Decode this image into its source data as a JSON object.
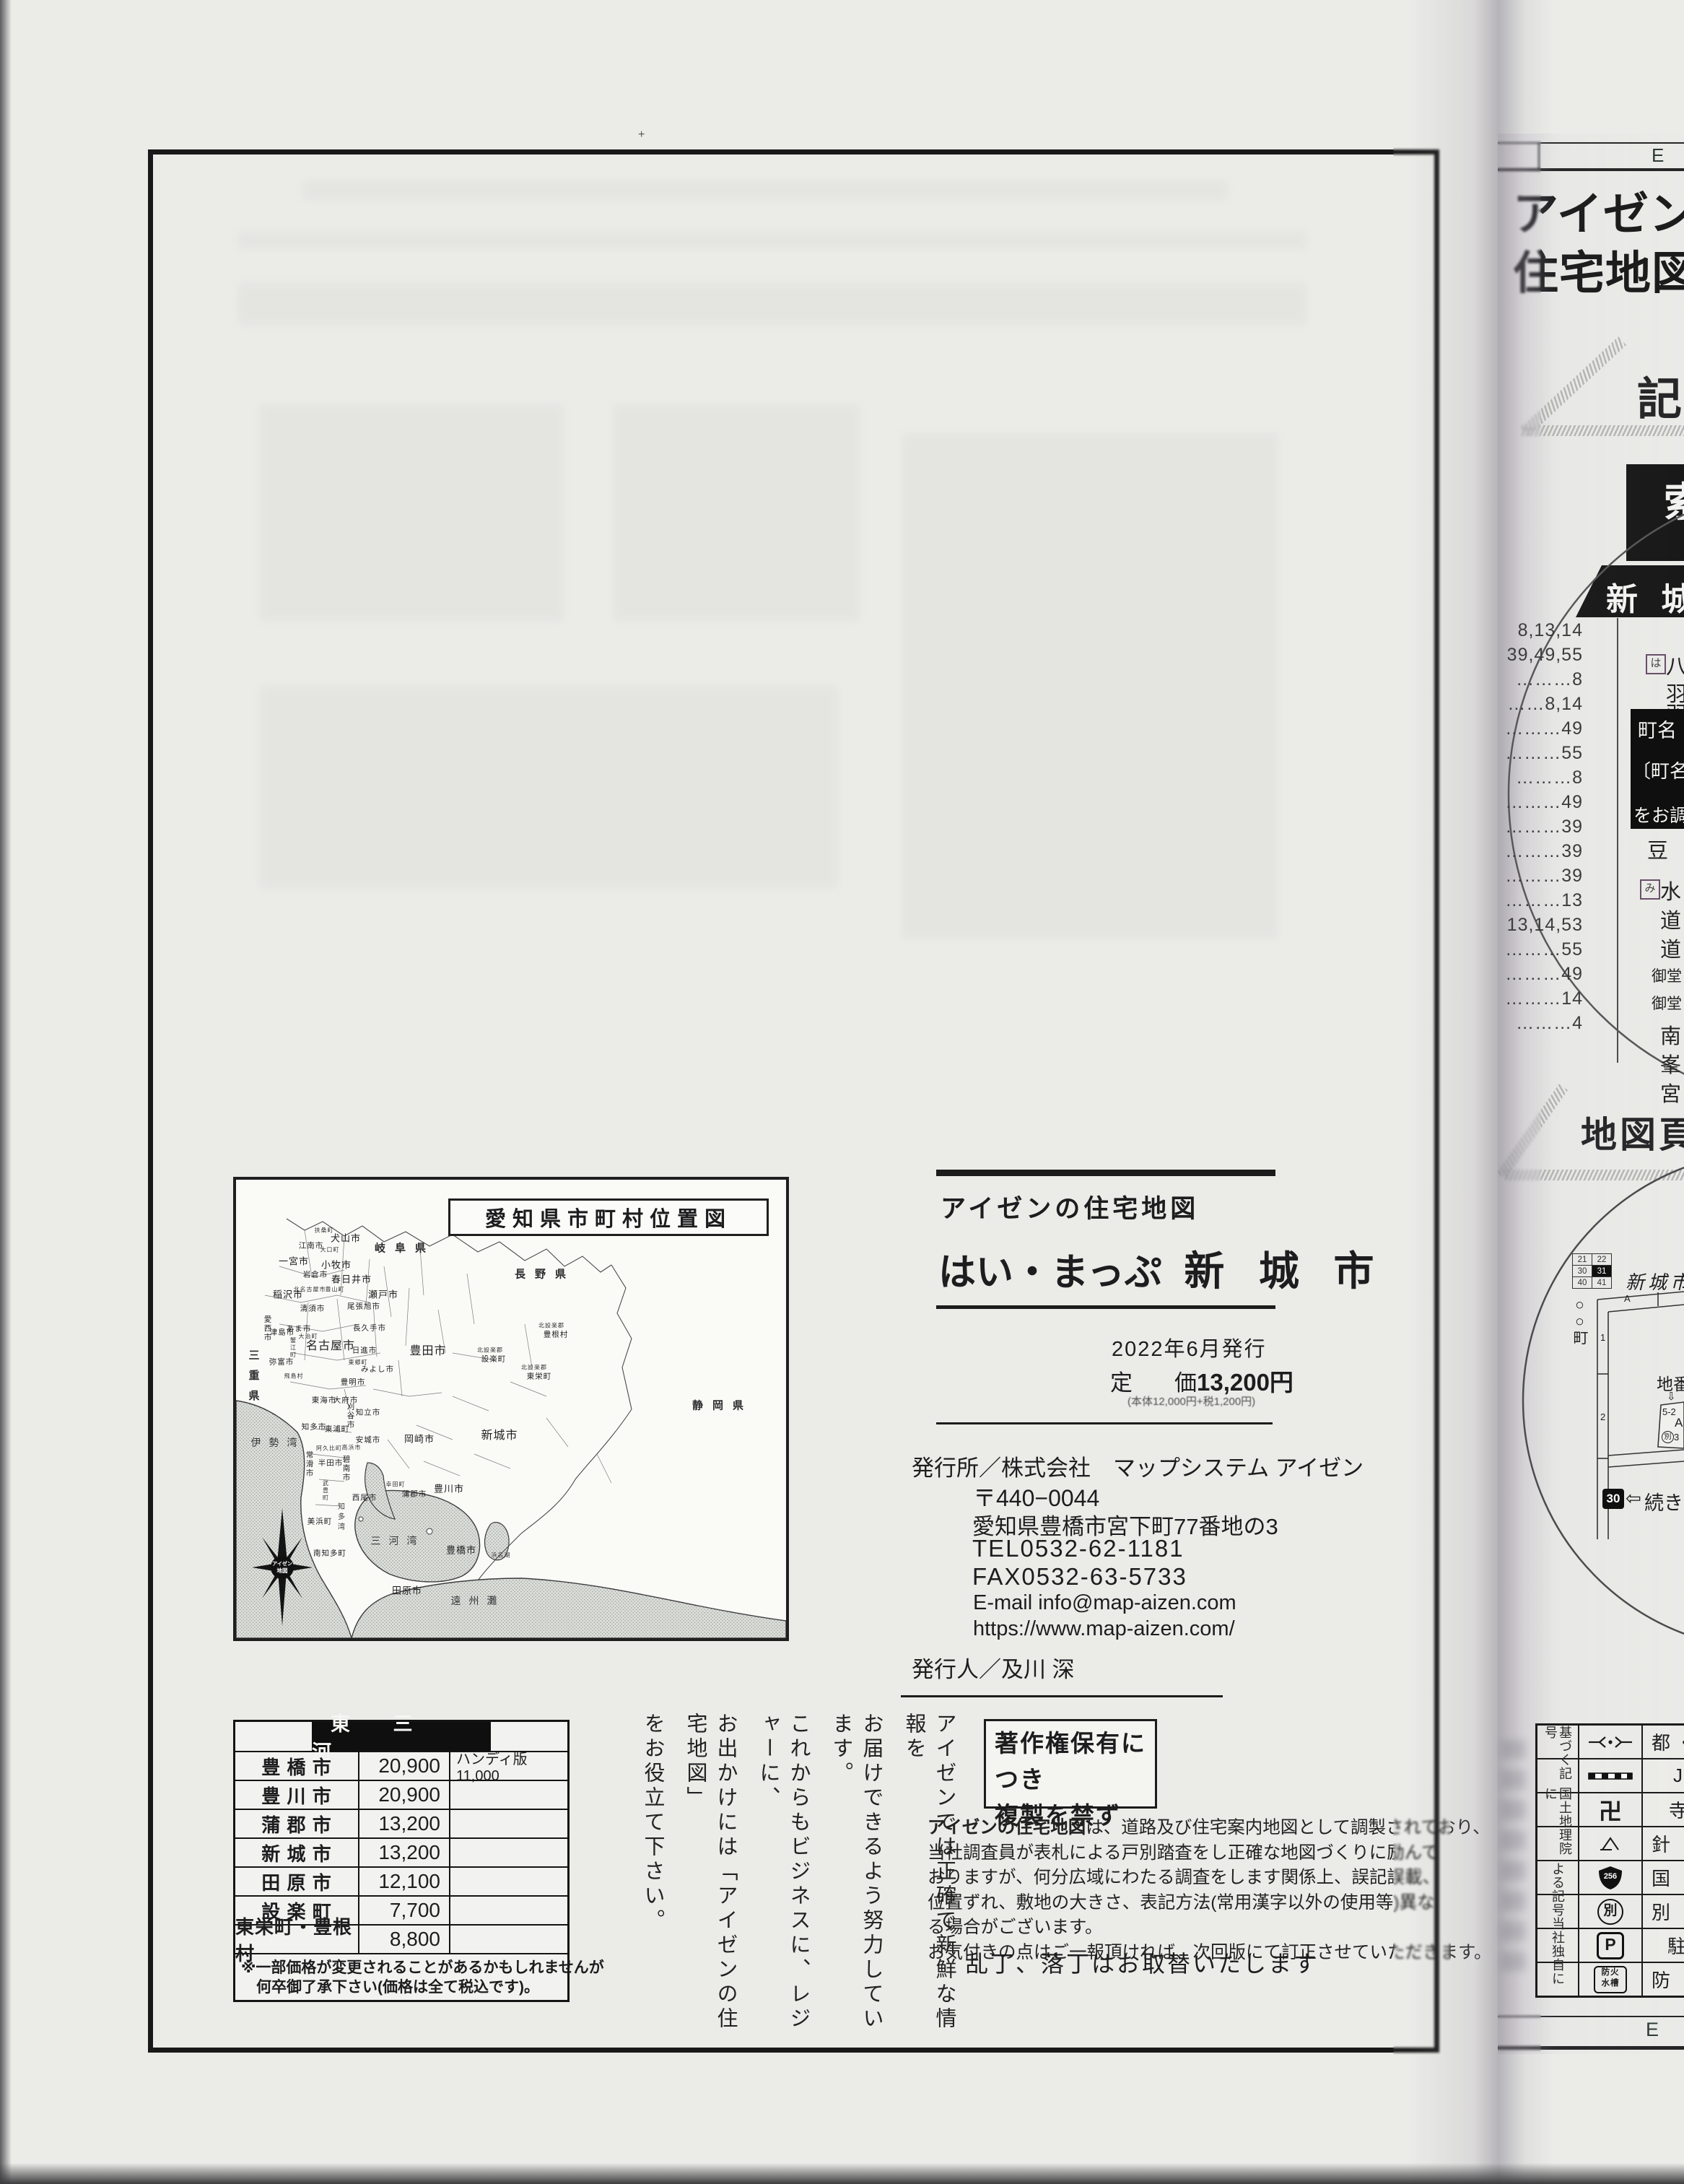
{
  "left": {
    "map": {
      "title": "愛知県市町村位置図",
      "compass_logo_line1": "アイゼン",
      "compass_logo_line2": "地図",
      "labels": [
        {
          "t": "岐阜県",
          "x": 234,
          "y": 94,
          "cls": "pref"
        },
        {
          "t": "長野県",
          "x": 428,
          "y": 130,
          "cls": "pref"
        },
        {
          "t": "静岡県",
          "x": 674,
          "y": 312,
          "cls": "pref"
        },
        {
          "t": "三重県",
          "x": 24,
          "y": 277,
          "cls": "pref v"
        },
        {
          "t": "伊勢湾",
          "x": 58,
          "y": 364,
          "cls": "sea"
        },
        {
          "t": "三河湾",
          "x": 224,
          "y": 500,
          "cls": "sea"
        },
        {
          "t": "遠州灘",
          "x": 335,
          "y": 583,
          "cls": "sea"
        },
        {
          "t": "知多湾",
          "x": 144,
          "y": 468,
          "cls": "sea v vsm"
        },
        {
          "t": "浜名湖",
          "x": 367,
          "y": 520,
          "cls": "xs"
        },
        {
          "t": "扶桑町",
          "x": 122,
          "y": 70,
          "cls": "xs"
        },
        {
          "t": "犬山市",
          "x": 152,
          "y": 80,
          "cls": ""
        },
        {
          "t": "江南市",
          "x": 104,
          "y": 91,
          "cls": "sm"
        },
        {
          "t": "大口町",
          "x": 130,
          "y": 97,
          "cls": "xs"
        },
        {
          "t": "一宮市",
          "x": 80,
          "y": 112,
          "cls": ""
        },
        {
          "t": "小牧市",
          "x": 139,
          "y": 117,
          "cls": ""
        },
        {
          "t": "岩倉市",
          "x": 110,
          "y": 131,
          "cls": "sm"
        },
        {
          "t": "春日井市",
          "x": 160,
          "y": 137,
          "cls": ""
        },
        {
          "t": "北名古屋市",
          "x": 102,
          "y": 152,
          "cls": "xs"
        },
        {
          "t": "豊山町",
          "x": 137,
          "y": 152,
          "cls": "xs"
        },
        {
          "t": "稲沢市",
          "x": 72,
          "y": 158,
          "cls": ""
        },
        {
          "t": "瀬戸市",
          "x": 204,
          "y": 158,
          "cls": ""
        },
        {
          "t": "清須市",
          "x": 106,
          "y": 178,
          "cls": "sm"
        },
        {
          "t": "尾張旭市",
          "x": 177,
          "y": 175,
          "cls": "sm"
        },
        {
          "t": "長久手市",
          "x": 185,
          "y": 205,
          "cls": "sm"
        },
        {
          "t": "愛西市",
          "x": 44,
          "y": 206,
          "cls": "v sm"
        },
        {
          "t": "あま市",
          "x": 87,
          "y": 206,
          "cls": "sm"
        },
        {
          "t": "大治町",
          "x": 100,
          "y": 217,
          "cls": "xs"
        },
        {
          "t": "津島市",
          "x": 64,
          "y": 211,
          "cls": "sm"
        },
        {
          "t": "名古屋市",
          "x": 131,
          "y": 228,
          "cls": "lg"
        },
        {
          "t": "日進市",
          "x": 178,
          "y": 236,
          "cls": "sm"
        },
        {
          "t": "豊田市",
          "x": 266,
          "y": 235,
          "cls": "lg"
        },
        {
          "t": "蟹江町",
          "x": 79,
          "y": 233,
          "cls": "xs v"
        },
        {
          "t": "弥富市",
          "x": 63,
          "y": 252,
          "cls": "sm"
        },
        {
          "t": "東郷町",
          "x": 169,
          "y": 253,
          "cls": "xs"
        },
        {
          "t": "みよし市",
          "x": 196,
          "y": 262,
          "cls": "sm"
        },
        {
          "t": "飛島村",
          "x": 80,
          "y": 272,
          "cls": "xs"
        },
        {
          "t": "豊明市",
          "x": 162,
          "y": 280,
          "cls": "sm"
        },
        {
          "t": "東海市",
          "x": 122,
          "y": 305,
          "cls": "sm"
        },
        {
          "t": "大府市",
          "x": 152,
          "y": 305,
          "cls": "sm"
        },
        {
          "t": "刈谷市",
          "x": 159,
          "y": 327,
          "cls": "v sm"
        },
        {
          "t": "知立市",
          "x": 183,
          "y": 322,
          "cls": "sm"
        },
        {
          "t": "北設楽郡",
          "x": 437,
          "y": 202,
          "cls": "xs"
        },
        {
          "t": "豊根村",
          "x": 443,
          "y": 214,
          "cls": "sm"
        },
        {
          "t": "北設楽郡",
          "x": 352,
          "y": 236,
          "cls": "xs"
        },
        {
          "t": "設楽町",
          "x": 357,
          "y": 248,
          "cls": "sm"
        },
        {
          "t": "北設楽郡",
          "x": 413,
          "y": 260,
          "cls": "xs"
        },
        {
          "t": "東栄町",
          "x": 420,
          "y": 272,
          "cls": "sm"
        },
        {
          "t": "知多市",
          "x": 108,
          "y": 342,
          "cls": "sm"
        },
        {
          "t": "東浦町",
          "x": 140,
          "y": 345,
          "cls": "sm"
        },
        {
          "t": "安城市",
          "x": 183,
          "y": 360,
          "cls": "sm"
        },
        {
          "t": "岡崎市",
          "x": 254,
          "y": 358,
          "cls": ""
        },
        {
          "t": "新城市",
          "x": 365,
          "y": 352,
          "cls": "lg"
        },
        {
          "t": "阿久比町",
          "x": 129,
          "y": 372,
          "cls": "xs"
        },
        {
          "t": "高浜市",
          "x": 160,
          "y": 371,
          "cls": "xs"
        },
        {
          "t": "常滑市",
          "x": 102,
          "y": 394,
          "cls": "v sm"
        },
        {
          "t": "半田市",
          "x": 131,
          "y": 392,
          "cls": "sm"
        },
        {
          "t": "碧南市",
          "x": 153,
          "y": 400,
          "cls": "v sm"
        },
        {
          "t": "武豊町",
          "x": 124,
          "y": 431,
          "cls": "v xs"
        },
        {
          "t": "幸田町",
          "x": 221,
          "y": 422,
          "cls": "xs"
        },
        {
          "t": "蒲郡市",
          "x": 247,
          "y": 435,
          "cls": "sm"
        },
        {
          "t": "豊川市",
          "x": 295,
          "y": 427,
          "cls": ""
        },
        {
          "t": "西尾市",
          "x": 178,
          "y": 440,
          "cls": "sm"
        },
        {
          "t": "美浜町",
          "x": 116,
          "y": 473,
          "cls": "sm"
        },
        {
          "t": "南知多町",
          "x": 130,
          "y": 517,
          "cls": "sm"
        },
        {
          "t": "豊橋市",
          "x": 312,
          "y": 512,
          "cls": ""
        },
        {
          "t": "田原市",
          "x": 237,
          "y": 568,
          "cls": ""
        }
      ]
    },
    "title_block": {
      "brand": "アイゼンの住宅地図",
      "series": "はい・まっぷ",
      "city": "新 城 市",
      "issue": "2022年6月発行",
      "price_label1": "定",
      "price_label2": "価",
      "price_value": "13,200円",
      "price_note": "(本体12,000円+税1,200円)"
    },
    "publisher": {
      "line1": "発行所／株式会社　マップシステム アイゼン",
      "postal": "〒440−0044",
      "address": "愛知県豊橋市宮下町77番地の3",
      "tel": "TEL0532-62-1181",
      "fax": "FAX0532-63-5733",
      "email": "E-mail info@map-aizen.com",
      "url": "https://www.map-aizen.com/",
      "issuer": "発行人／及川 深"
    },
    "copyright": {
      "line1": "著作権保有につき",
      "line2": "複製を禁ず"
    },
    "disclaimer": {
      "lead": "アイゼンの住宅地図",
      "lines": [
        "は、道路及び住宅案内地図として調製されており、",
        "当社調査員が表札による戸別踏査をし正確な地図づくりに励んで",
        "おりますが、何分広域にわたる調査をします関係上、誤記誤載、",
        "位置ずれ、敷地の大きさ、表記方法(常用漢字以外の使用等)異な",
        "る場合がございます。",
        "お気付きの点はご一報頂ければ、次回版にて訂正させていただきます。"
      ]
    },
    "exchange_note": "乱丁、落丁はお取替いたします",
    "price_table": {
      "region": "東 三 河",
      "rows": [
        {
          "name": "豊 橋 市",
          "price": "20,900",
          "note": "ハンディ版11,000"
        },
        {
          "name": "豊 川 市",
          "price": "20,900",
          "note": ""
        },
        {
          "name": "蒲 郡 市",
          "price": "13,200",
          "note": ""
        },
        {
          "name": "新 城 市",
          "price": "13,200",
          "note": ""
        },
        {
          "name": "田 原 市",
          "price": "12,100",
          "note": ""
        },
        {
          "name": "設 楽 町",
          "price": "7,700",
          "note": ""
        },
        {
          "name": "東栄町・豊根村",
          "price": "8,800",
          "note": ""
        }
      ],
      "note1": "※一部価格が変更されることがあるかもしれませんが",
      "note2": "　何卒御了承下さい(価格は全て税込です)。"
    },
    "slogan": [
      "アイゼンでは正確で新鮮な情報を",
      "お届けできるよう努力しています。",
      "これからもビジネスに、レジャーに、",
      "お出かけには「アイゼンの住宅地図」",
      "をお役立て下さい。"
    ]
  },
  "right": {
    "header_letter": "E",
    "footer_letter": "E",
    "masthead_line1": "アイゼン",
    "masthead_line2": "住宅地図",
    "section_kigo": "記",
    "index_box_char": "索",
    "city_bar": "新 城",
    "index_numbers": [
      "8,13,14",
      "39,49,55",
      "………8",
      "……8,14",
      "………49",
      "………55",
      "………8",
      "………49",
      "………39",
      "………39",
      "………39",
      "………13",
      "13,14,53",
      "………55",
      "………49",
      "………14",
      "………4"
    ],
    "index_frags": [
      {
        "t": "は",
        "x": 2280,
        "y": 906,
        "cls": "box"
      },
      {
        "t": "八",
        "x": 2308,
        "y": 900
      },
      {
        "t": "羽",
        "x": 2308,
        "y": 938
      },
      {
        "t": "羽",
        "x": 2308,
        "y": 966
      },
      {
        "t": "豆",
        "x": 2282,
        "y": 1155
      },
      {
        "t": "み",
        "x": 2272,
        "y": 1218,
        "cls": "box"
      },
      {
        "t": "水",
        "x": 2300,
        "y": 1212
      },
      {
        "t": "道",
        "x": 2300,
        "y": 1252
      },
      {
        "t": "道",
        "x": 2300,
        "y": 1292
      },
      {
        "t": "御堂",
        "x": 2288,
        "y": 1336,
        "cls": "sm2"
      },
      {
        "t": "御堂",
        "x": 2288,
        "y": 1374,
        "cls": "sm2"
      },
      {
        "t": "南",
        "x": 2300,
        "y": 1412
      },
      {
        "t": "峯",
        "x": 2300,
        "y": 1452
      },
      {
        "t": "宮",
        "x": 2300,
        "y": 1492
      }
    ],
    "town_box": {
      "line1": "町名",
      "line2": "〔町名",
      "line3": "をお調"
    },
    "section_map_page": "地図頁",
    "sample": {
      "grid": [
        [
          "21",
          "22"
        ],
        [
          "30",
          "31"
        ],
        [
          "40",
          "41"
        ]
      ],
      "town": "○○町",
      "city_script": "新城市",
      "col_label": "A",
      "row1": "1",
      "row2": "2",
      "chiban": "地番",
      "arrow_down": "⇩",
      "parcel_no": "5-2",
      "parcel_col": "A",
      "parcel_mark": "別",
      "parcel_num": "3",
      "cont_page": "30",
      "cont_arrow": "⇦",
      "cont_text": "続きペ"
    },
    "legend": {
      "group1a": "国土地理院に",
      "group1b": "基づく記号",
      "group2a": "当社独自に",
      "group2b": "よる記号",
      "rows": [
        {
          "desc": "都・"
        },
        {
          "desc": "J"
        },
        {
          "desc": "寺"
        },
        {
          "desc": "針 葉"
        },
        {
          "desc": "国 道"
        },
        {
          "desc": "別 記"
        },
        {
          "desc": "駐"
        },
        {
          "desc": "防 火"
        }
      ],
      "sym_manji": "卍",
      "sym_betsu": "別",
      "sym_p": "P",
      "sym_tank1": "防火",
      "sym_tank2": "水槽",
      "sym_route": "256"
    }
  }
}
